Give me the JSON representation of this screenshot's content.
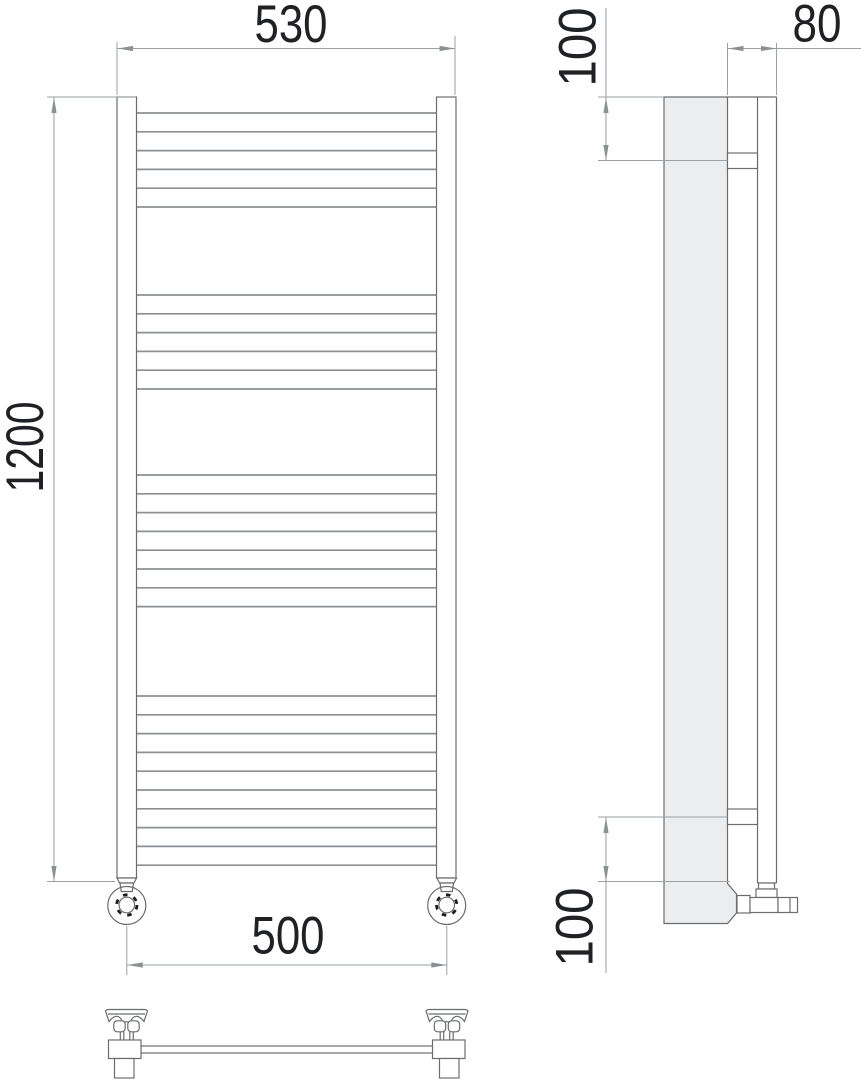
{
  "drawing": {
    "type": "technical-dimension-drawing",
    "subject": "ladder-style towel radiator, front view / side view / top view",
    "dimensions": {
      "front_width_top": "530",
      "front_height": "1200",
      "front_width_bottom": "500",
      "side_depth": "80",
      "side_offset_top": "100",
      "side_offset_bottom": "100"
    },
    "front_view": {
      "rung_x1": 136.5,
      "rung_x2": 436.5,
      "rung_pitch": 18.8,
      "rung_groups": [
        {
          "count": 6,
          "start_y": 113
        },
        {
          "count": 6,
          "start_y": 295
        },
        {
          "count": 8,
          "start_y": 475
        },
        {
          "count": 10,
          "start_y": 696
        }
      ]
    }
  },
  "colors": {
    "background": "#ffffff",
    "object_line": "#6a6d70",
    "rung_line": "#8d9093",
    "dim_line": "#9ba1a5",
    "arrow": "#8a9093",
    "text": "#202124",
    "panel_fill": "#ecedee",
    "valve_dash": "#1b1b1b"
  }
}
